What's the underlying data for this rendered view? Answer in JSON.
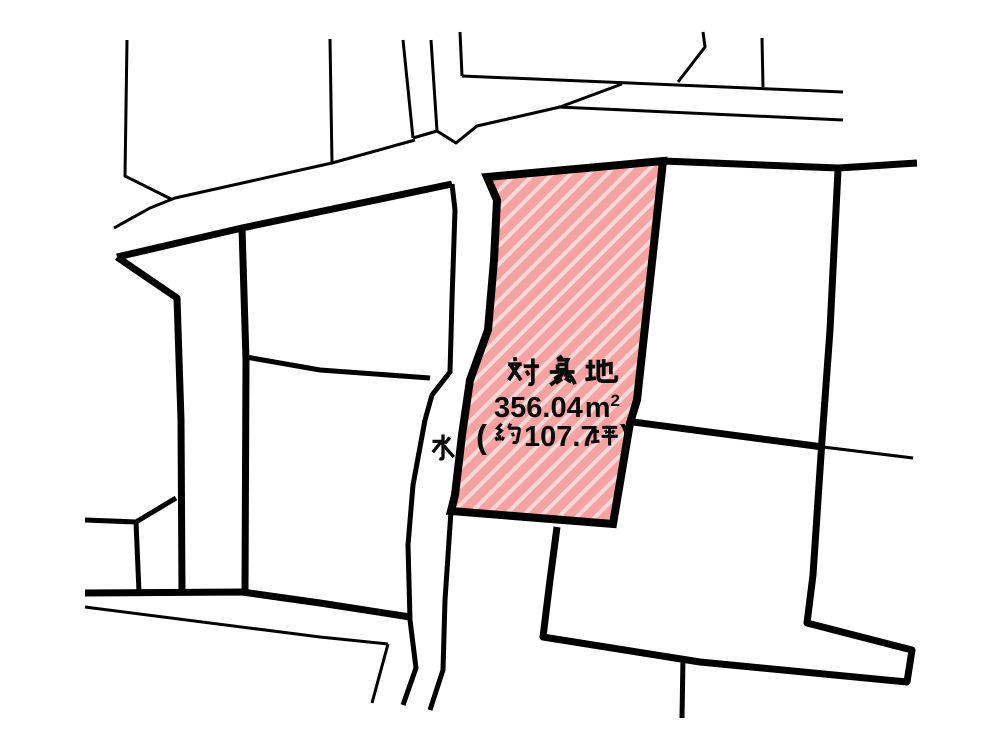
{
  "map": {
    "background_color": "#ffffff",
    "line_color": "#000000",
    "subject_parcel": {
      "label_title": "対象地",
      "label_area": "356.04㎡",
      "area_value": "356.04",
      "area_unit_base": "m",
      "area_unit_exponent": "2",
      "label_tsubo": "（約107.7坪）",
      "tsubo_paren_open": "(",
      "tsubo_prefix": "約",
      "tsubo_value": "107.7",
      "tsubo_unit": "坪",
      "tsubo_paren_close": ")",
      "fill_color": "#f5a2a2",
      "hatch_color": "#fbd7d7"
    },
    "water_label": "水"
  }
}
